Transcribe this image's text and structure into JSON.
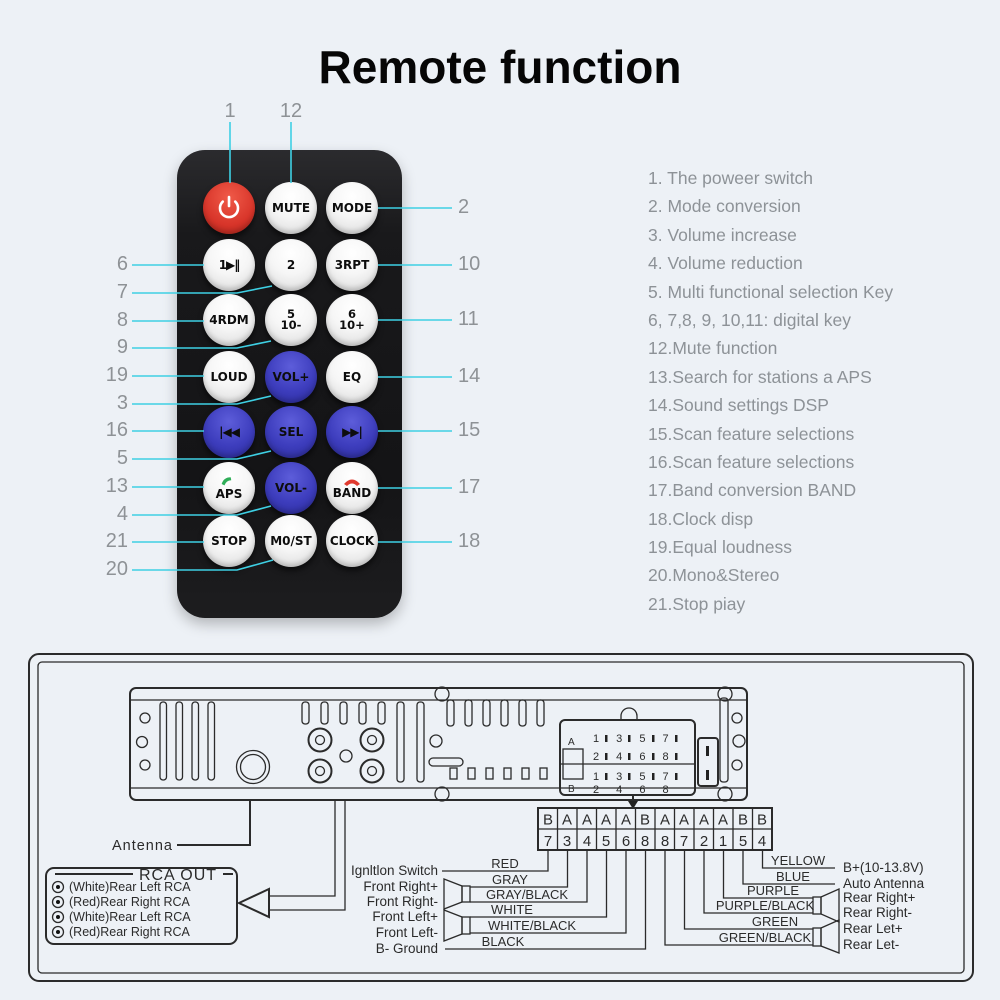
{
  "title": "Remote function",
  "colors": {
    "background": "#edf1f6",
    "callout_line": "#3ed0e4",
    "callout_number": "#8e9296",
    "remote_body": "#1a1a1c",
    "button_blue": "#3d3dbd",
    "button_red": "#d8352a",
    "list_text": "#8d9297",
    "diagram_ink": "#2b2b2b",
    "phone_answer_green": "#2fae58",
    "phone_hangup_red": "#e03a2f"
  },
  "remote": {
    "buttons": [
      {
        "id": "power",
        "label": "",
        "icon": "power-icon",
        "color": "red"
      },
      {
        "id": "mute",
        "label": "MUTE",
        "color": "white"
      },
      {
        "id": "mode",
        "label": "MODE",
        "color": "white"
      },
      {
        "id": "key1",
        "label": "1▶‖",
        "color": "white"
      },
      {
        "id": "key2",
        "label": "2",
        "color": "white"
      },
      {
        "id": "key3",
        "label": "3RPT",
        "color": "white"
      },
      {
        "id": "key4",
        "label": "4RDM",
        "color": "white"
      },
      {
        "id": "key5",
        "label": "5",
        "label2": "10-",
        "color": "white"
      },
      {
        "id": "key6",
        "label": "6",
        "label2": "10+",
        "color": "white"
      },
      {
        "id": "loud",
        "label": "LOUD",
        "color": "white"
      },
      {
        "id": "vol-up",
        "label": "VOL+",
        "color": "blue"
      },
      {
        "id": "eq",
        "label": "EQ",
        "color": "white"
      },
      {
        "id": "prev",
        "label": "|◀◀",
        "color": "blue"
      },
      {
        "id": "sel",
        "label": "SEL",
        "color": "blue"
      },
      {
        "id": "next",
        "label": "▶▶|",
        "color": "blue"
      },
      {
        "id": "aps",
        "label": "APS",
        "icon": "phone-answer-icon",
        "color": "white"
      },
      {
        "id": "vol-down",
        "label": "VOL-",
        "color": "blue"
      },
      {
        "id": "band",
        "label": "BAND",
        "icon": "phone-hangup-icon",
        "color": "white"
      },
      {
        "id": "stop",
        "label": "STOP",
        "color": "white"
      },
      {
        "id": "most",
        "label": "M0/ST",
        "color": "white"
      },
      {
        "id": "clock",
        "label": "CLOCK",
        "color": "white"
      }
    ],
    "callouts": {
      "top": [
        "1",
        "12"
      ],
      "left": [
        "6",
        "7",
        "8",
        "9",
        "19",
        "3",
        "16",
        "5",
        "13",
        "4",
        "21",
        "20"
      ],
      "right": [
        "2",
        "10",
        "11",
        "14",
        "15",
        "17",
        "18"
      ]
    }
  },
  "functions": [
    "1. The poweer switch",
    "2. Mode conversion",
    "3. Volume increase",
    "4. Volume reduction",
    "5. Multi functional selection Key",
    "6, 7,8, 9, 10,11: digital key",
    "12.Mute function",
    "13.Search for stations a APS",
    "14.Sound settings DSP",
    "15.Scan feature selections",
    "16.Scan feature selections",
    "17.Band conversion BAND",
    "18.Clock disp",
    "19.Equal loudness",
    "20.Mono&Stereo",
    "21.Stop piay"
  ],
  "wiring": {
    "antenna_label": "Antenna",
    "rca_out": {
      "title": "RCA OUT",
      "items": [
        "(White)Rear Left RCA",
        "(Red)Rear Right RCA",
        "(White)Rear Left RCA",
        "(Red)Rear Right RCA"
      ]
    },
    "iso_block": {
      "section_a": "A",
      "section_b": "B",
      "rows": [
        "1 3 5 7",
        "2 4 6 8",
        "1 3 5 7",
        "2 4 6 8"
      ]
    },
    "connector_table": {
      "letters": [
        "B",
        "A",
        "A",
        "A",
        "A",
        "B",
        "A",
        "A",
        "A",
        "A",
        "B",
        "B"
      ],
      "numbers": [
        "7",
        "3",
        "4",
        "5",
        "6",
        "8",
        "8",
        "7",
        "2",
        "1",
        "5",
        "4"
      ]
    },
    "left_wires": [
      {
        "label": "Ignltlon Switch",
        "color_name": "RED"
      },
      {
        "label": "Front Right+",
        "color_name": "GRAY"
      },
      {
        "label": "Front Right-",
        "color_name": "GRAY/BLACK"
      },
      {
        "label": "Front Left+",
        "color_name": "WHITE"
      },
      {
        "label": "Front Left-",
        "color_name": "WHITE/BLACK"
      },
      {
        "label": "B- Ground",
        "color_name": "BLACK"
      }
    ],
    "right_wires": [
      {
        "color_name": "YELLOW",
        "label": "B+(10-13.8V)"
      },
      {
        "color_name": "BLUE",
        "label": "Auto Antenna"
      },
      {
        "color_name": "PURPLE",
        "label": "Rear Right+"
      },
      {
        "color_name": "PURPLE/BLACK",
        "label": "Rear Right-"
      },
      {
        "color_name": "GREEN",
        "label": "Rear Let+"
      },
      {
        "color_name": "GREEN/BLACK",
        "label": "Rear Let-"
      }
    ]
  }
}
